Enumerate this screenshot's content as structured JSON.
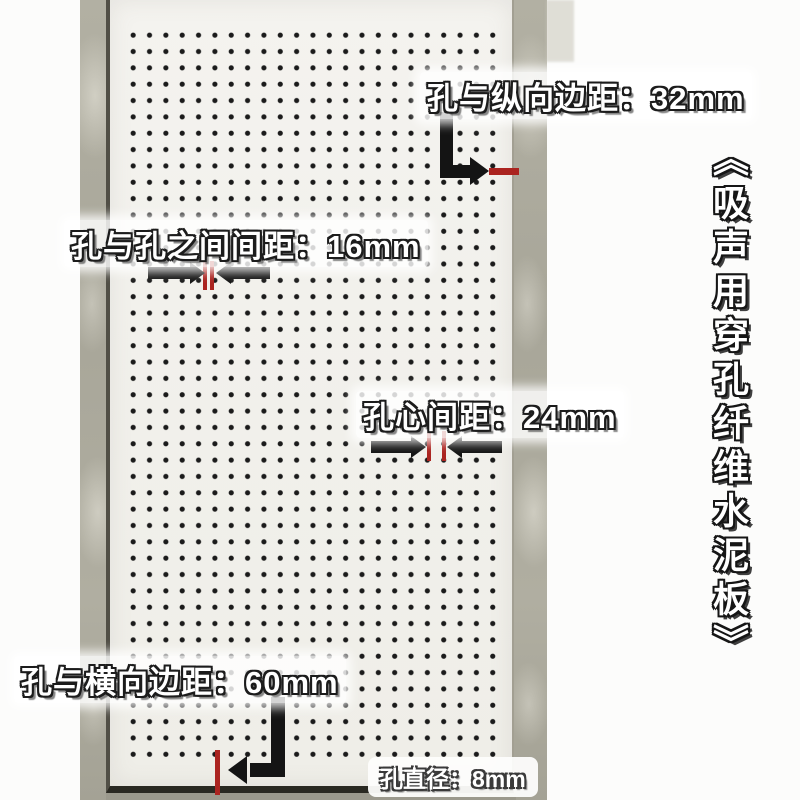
{
  "product_title": "《吸声用穿孔纤维水泥板》",
  "annotations": {
    "vertical_edge": {
      "label": "孔与纵向边距：32mm",
      "value_mm": 32
    },
    "hole_gap": {
      "label": "孔与孔之间间距：16mm",
      "value_mm": 16
    },
    "hole_center": {
      "label": "孔心间距：24mm",
      "value_mm": 24
    },
    "horizontal_edge": {
      "label": "孔与横向边距：60mm",
      "value_mm": 60
    },
    "hole_diameter": {
      "label": "孔直径：8mm",
      "value_mm": 8
    }
  },
  "colors": {
    "measure-red": "#ab2420",
    "arrow-black": "#141414",
    "board-white": "#f2f1ec",
    "tile-grey": "#adab9e",
    "dot-black": "#1b1b1b"
  }
}
